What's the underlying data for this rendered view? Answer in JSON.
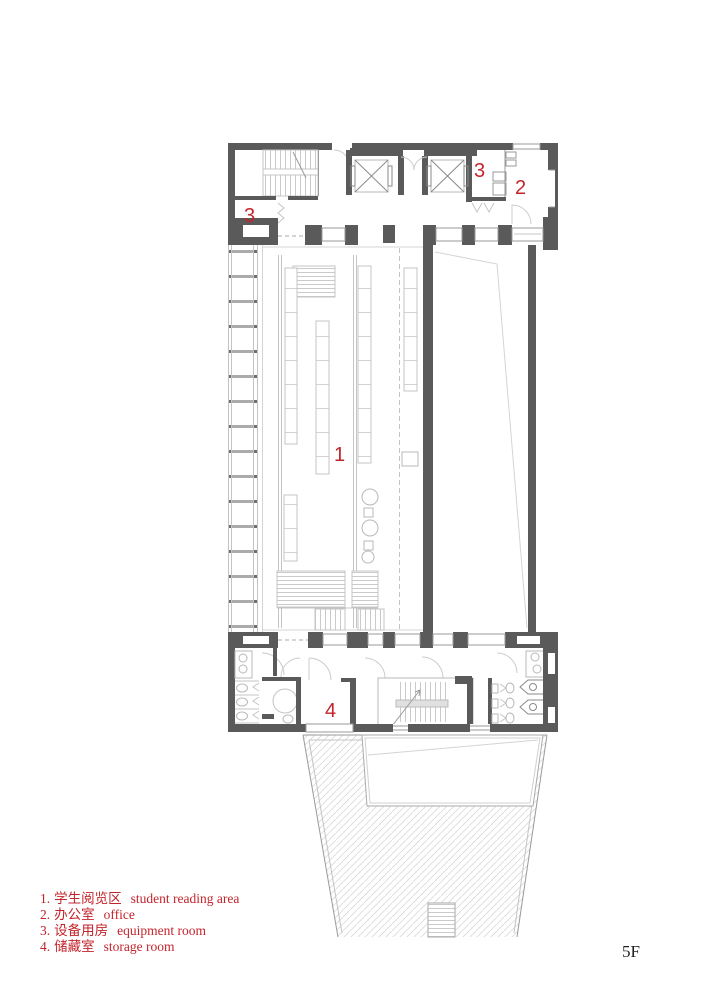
{
  "plan": {
    "floor_label": "5F",
    "room_markers": [
      {
        "room": "equipment-room-top-left",
        "text": "3"
      },
      {
        "room": "equipment-room-top-right",
        "text": "3"
      },
      {
        "room": "office",
        "text": "2"
      },
      {
        "room": "student-reading-area",
        "text": "1"
      },
      {
        "room": "storage-room",
        "text": "4"
      }
    ],
    "colors": {
      "marker_red": "#c3242c",
      "wall_gray": "#5a5a5a",
      "furniture_line_gray": "#bdbdbd",
      "hatch_gray": "#d9d9d9",
      "floor_label_black": "#1f1f1f"
    }
  },
  "legend": {
    "items": [
      {
        "num": "1.",
        "zh": "学生阅览区",
        "en": "student reading area"
      },
      {
        "num": "2.",
        "zh": "办公室",
        "en": "office"
      },
      {
        "num": "3.",
        "zh": "设备用房",
        "en": "equipment room"
      },
      {
        "num": "4.",
        "zh": "储藏室",
        "en": "storage room"
      }
    ]
  }
}
